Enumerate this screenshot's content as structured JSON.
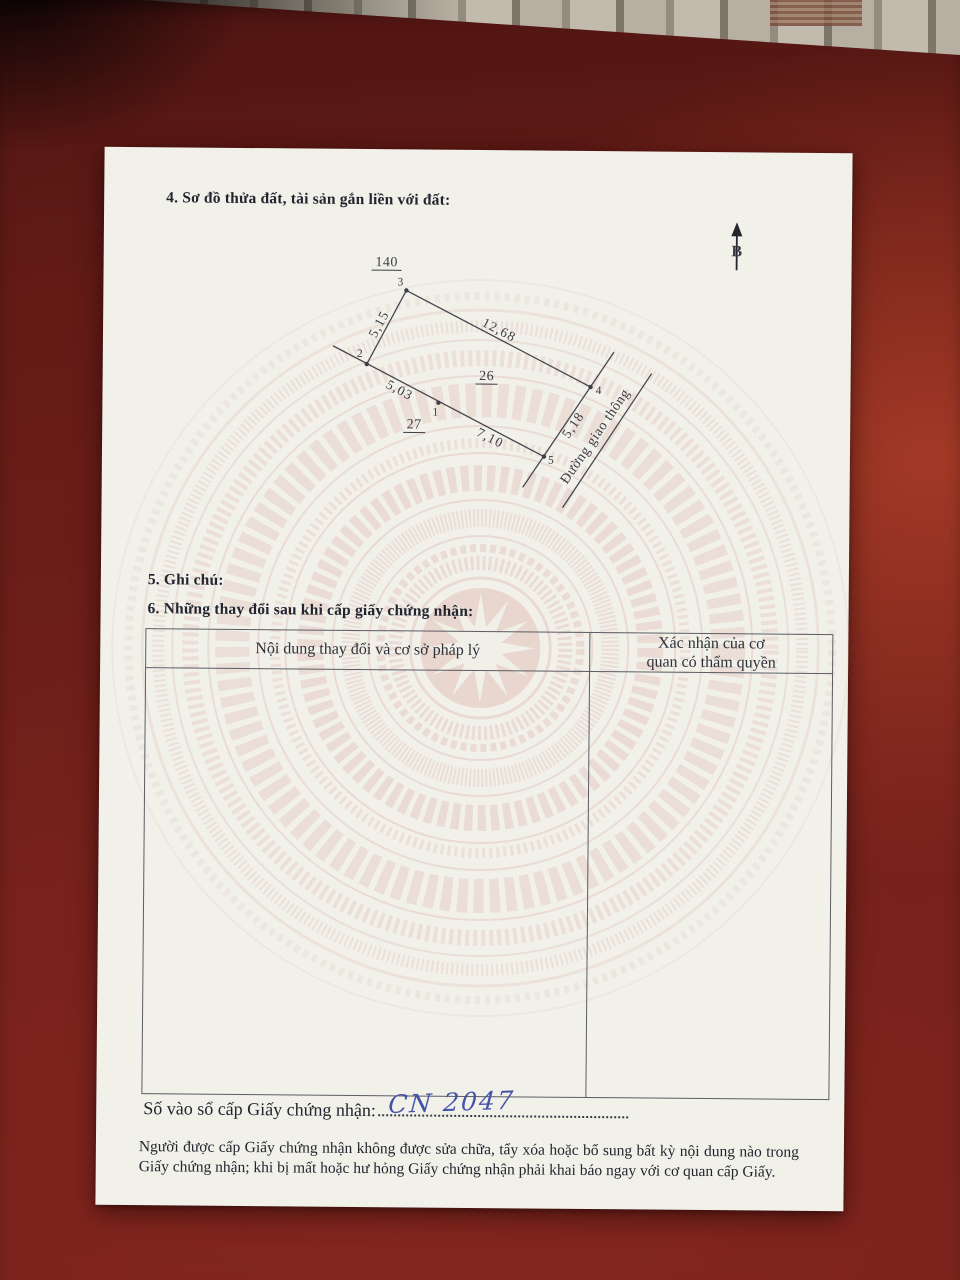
{
  "document": {
    "section4_title": "4. Sơ đồ thửa đất, tài sản gắn liền với đất:",
    "section5_title": "5. Ghi chú:",
    "section6_title": "6. Những thay đổi sau khi cấp giấy chứng nhận:",
    "table": {
      "col1_header": "Nội dung thay đổi và cơ sở pháp lý",
      "col2_header_line1": "Xác nhận của cơ",
      "col2_header_line2": "quan có thẩm quyền"
    },
    "registry_line_label": "Số vào sổ cấp Giấy chứng nhận:",
    "registry_number_handwritten": "CN 2047",
    "footer_note": "Người được cấp Giấy chứng nhận không được sửa chữa, tẩy xóa hoặc bổ sung bất kỳ nội dung nào trong Giấy chứng nhận; khi bị mất hoặc hư hỏng Giấy chứng nhận phải khai báo ngay với cơ quan cấp Giấy."
  },
  "diagram": {
    "north_label": "B",
    "parcel_number": "26",
    "adjacent_parcel_top": "140",
    "adjacent_parcel_bottom_left": "27",
    "road_label": "Đường giao thông",
    "vertex_labels": [
      "1",
      "2",
      "3",
      "4",
      "5"
    ],
    "edge_lengths": {
      "edge_2_3": "5,15",
      "edge_3_4": "12,68",
      "edge_1_2": "5,03",
      "edge_1_5": "7,10",
      "edge_4_5": "5,18"
    }
  },
  "colors": {
    "surface_red": "#701f1a",
    "paper": "#f1f1ea",
    "watermark_pink": "#e0bfb7",
    "ink_blue": "#4353a8",
    "print_ink": "#2b2d38"
  }
}
